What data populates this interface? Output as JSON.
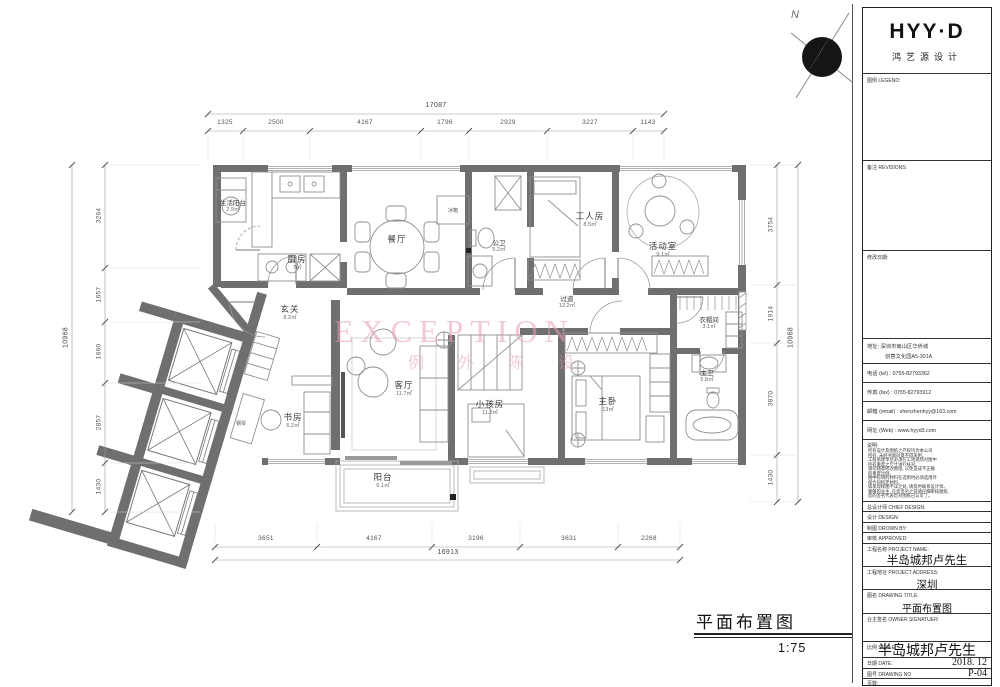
{
  "sheet": {
    "brand": {
      "logo": "HYY·D",
      "sub": "鸿艺源设计"
    },
    "sections": {
      "legend": "图例 LEGEND:",
      "revisions": "备注 REVISIONS:",
      "modify_date": "修改日期:"
    },
    "contact": {
      "address1": "地址:  深圳市南山区华侨城",
      "address2": "创意文化园A5-301A",
      "tel": "电话 (tel) : 0755-82793362",
      "fax": "传真 (fax) : 0755-82793912",
      "email": "邮箱 (email) : shenzhenhyy@163.com",
      "web": "网址 (Web) : www.hyyd3.com"
    },
    "notes_label": "说明:",
    "notes": [
      "所有设计及图纸之产权均为本公司",
      "所有, 未经书面同意不得采用。",
      "工程承建单位必须在工地现场对图中",
      "所有重度之尺寸进行核对。",
      "请勿随意修改图纸, 以免造成不正确",
      "的重度比例。",
      "图中标明的材料在选用时必须选用环",
      "保合同指定材料。",
      "如发现样图不详之处, 请及时联系设计师。",
      "尊敬的业主, 在您签名之前请仔细审核图纸,",
      "您的签名代表您对图纸已认可了。"
    ],
    "fields": {
      "chief": "总设计师 CHIEF DESIGN:",
      "design": "设计 DESIGN:",
      "drawn": "制图 DROWN BY:",
      "approved": "审核 APPROVED:",
      "project_name_label": "工程名称 PROJECT NAME:",
      "project_name": "半岛城邦卢先生",
      "project_address_label": "工程地址 PROJECT ADDRESS:",
      "project_address": "深圳",
      "drawing_title_label": "图名 DRAWING TITLE:",
      "drawing_title": "平面布置图",
      "owner_label": "业主签名 OWNER SIGNATUER:",
      "scale_label": "比例 SCALE:",
      "scale_overlay": "半岛城邦卢先生",
      "date_label": "日期 DATE.",
      "date_value": "2018. 12",
      "no_label": "图号 DRAWING NO",
      "no_value": "P-04",
      "pages_label": "页数:"
    }
  },
  "plan": {
    "title": "平面布置图",
    "scale": "1:75",
    "north": "N",
    "watermark": {
      "line1": "EXCEPTION",
      "line2": "例外陈设"
    },
    "rooms": {
      "service_balcony": {
        "name": "生活阳台",
        "area": "2.9㎡"
      },
      "kitchen": {
        "name": "厨房",
        "area": "7㎡"
      },
      "dining": {
        "name": "餐厅"
      },
      "public_bath": {
        "name": "公卫",
        "area": "5.2㎡"
      },
      "worker": {
        "name": "工人房",
        "area": "8.5㎡"
      },
      "activity": {
        "name": "活动室",
        "area": "9.1㎡"
      },
      "corridor": {
        "name": "过道",
        "area": "12.2㎡"
      },
      "cloak": {
        "name": "衣帽间",
        "area": "3.1㎡"
      },
      "master_bath": {
        "name": "主卫",
        "area": "5.8㎡"
      },
      "master": {
        "name": "主卧",
        "area": "13㎡"
      },
      "kids": {
        "name": "小孩房",
        "area": "11.2㎡"
      },
      "living": {
        "name": "客厅",
        "area": "11.7㎡"
      },
      "study": {
        "name": "书房",
        "area": "6.2㎡"
      },
      "foyer": {
        "name": "玄关",
        "area": "8.2㎡"
      },
      "balcony": {
        "name": "阳台",
        "area": "6.1㎡"
      }
    },
    "labels": {
      "fridge": "冰箱",
      "piano": "钢琴"
    },
    "dims": {
      "top": [
        "1325",
        "2500",
        "4167",
        "1796",
        "2929",
        "3227",
        "1143"
      ],
      "top_total": "17087",
      "bottom": [
        "3651",
        "4167",
        "3196",
        "3631",
        "2268"
      ],
      "bottom_total": "16913",
      "left": [
        "3264",
        "1657",
        "1660",
        "2857",
        "1430"
      ],
      "left_total": "10968",
      "right": [
        "3754",
        "1914",
        "3870",
        "1430"
      ],
      "right_total": "10968"
    }
  }
}
